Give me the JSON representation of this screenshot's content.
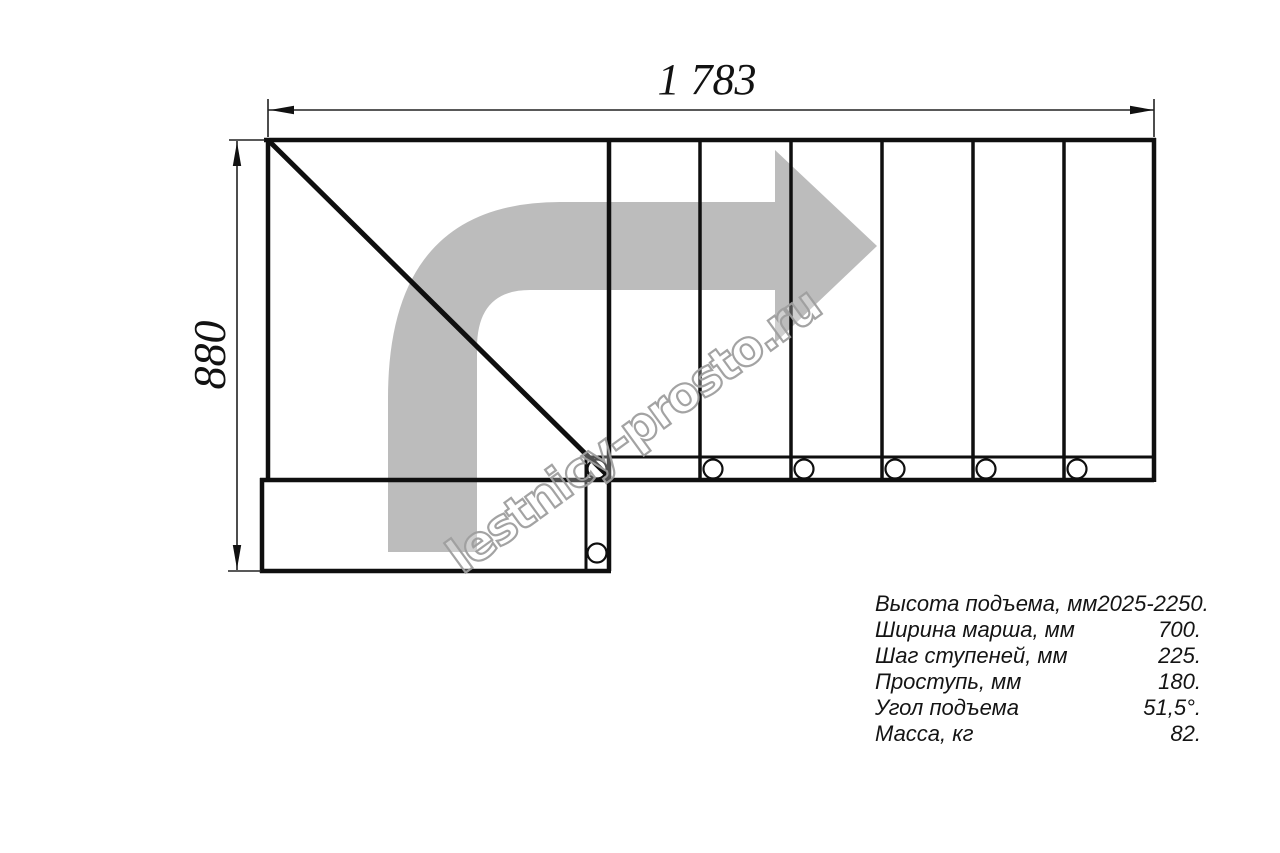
{
  "drawing": {
    "title_hint": "stair plan view (L-shaped staircase, top view)",
    "dimensions": {
      "width_label": "1 783",
      "height_label": "880"
    },
    "watermark": "lestnicy-prosto.ru",
    "colors": {
      "line": "#0f0f0f",
      "direction_arrow": "#bcbcbc",
      "watermark_outline": "#9e9e9e"
    }
  },
  "specs": {
    "rows": [
      {
        "label": "Высота подъема, мм",
        "value": "2025-2250."
      },
      {
        "label": "Ширина марша, мм",
        "value": "700."
      },
      {
        "label": "Шаг ступеней, мм",
        "value": "225."
      },
      {
        "label": "Проступь, мм",
        "value": "180."
      },
      {
        "label": "Угол подъема",
        "value": "51,5°."
      },
      {
        "label": "Масса, кг",
        "value": "82."
      }
    ]
  }
}
